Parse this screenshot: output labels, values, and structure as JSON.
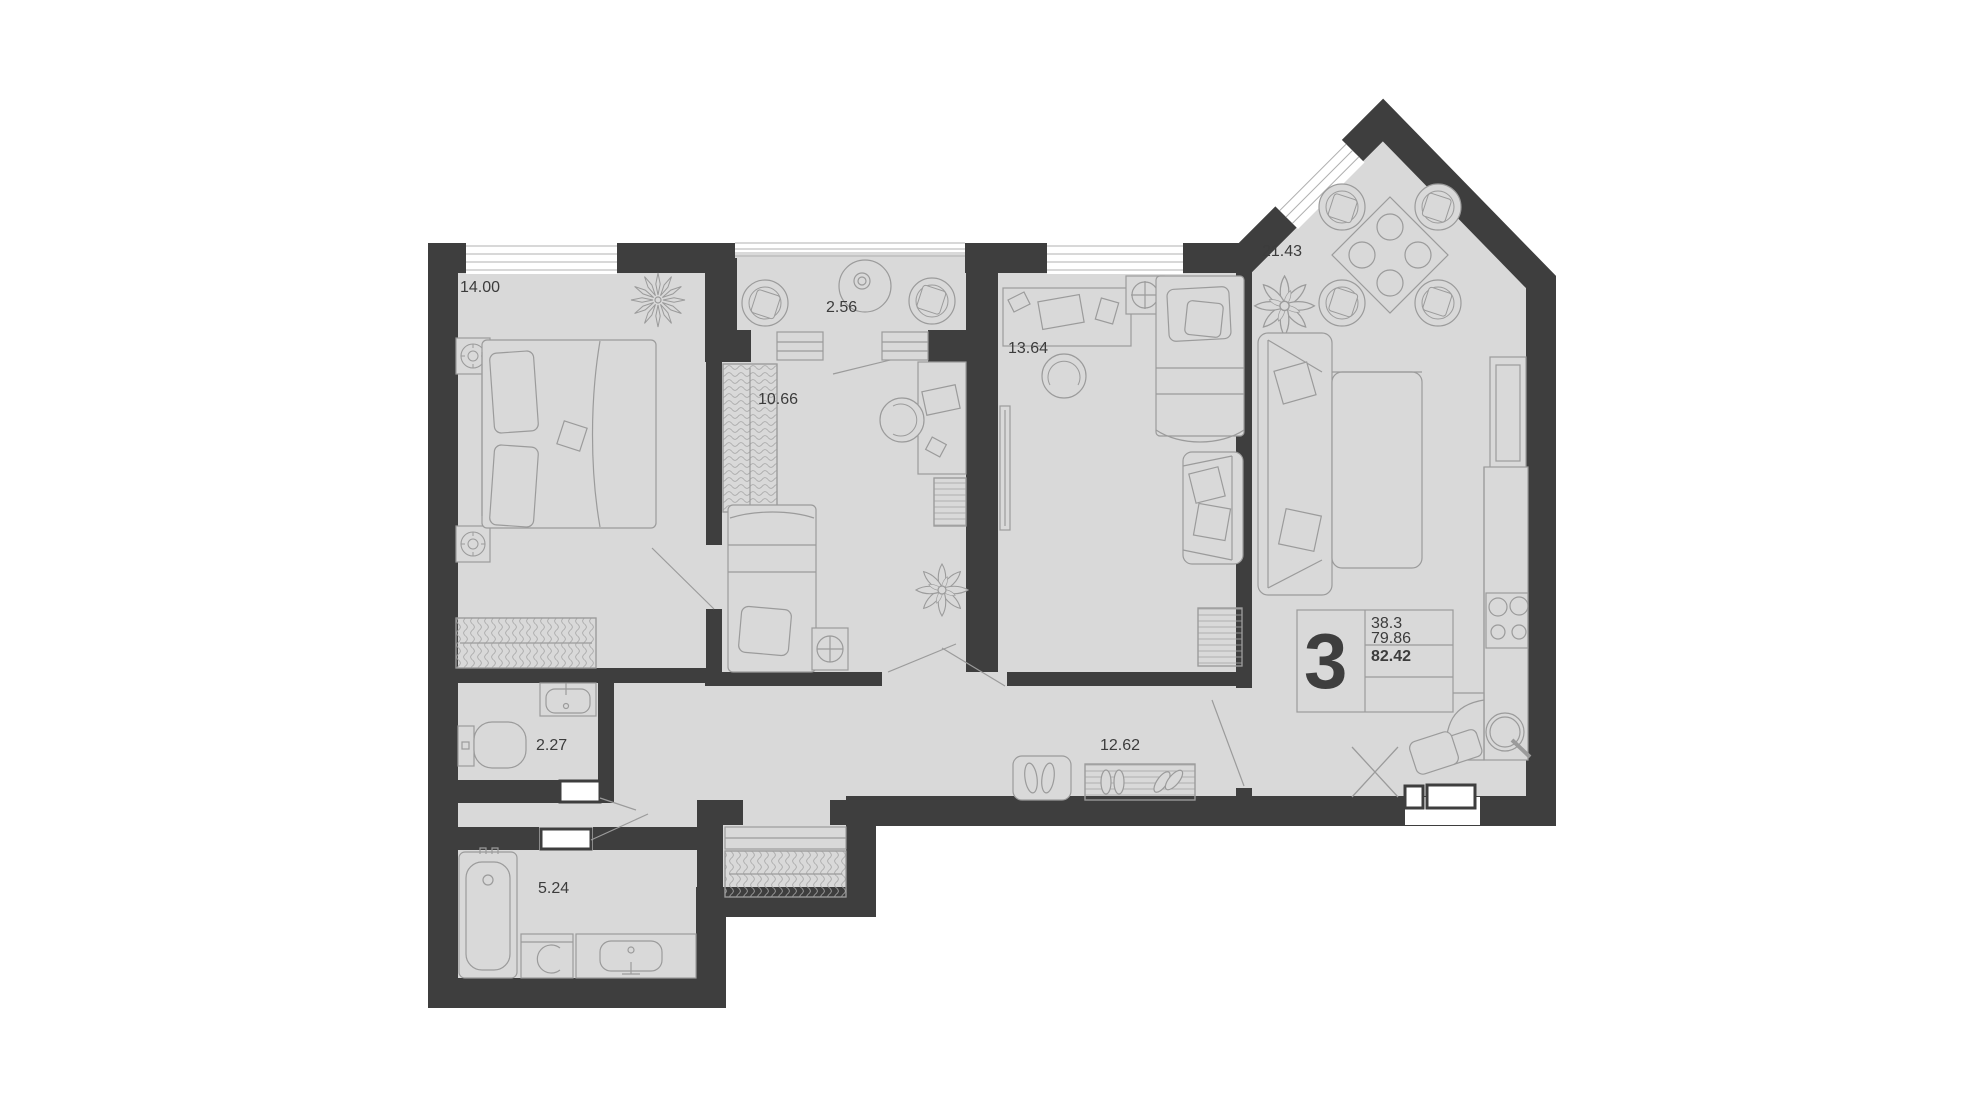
{
  "plan": {
    "legend": {
      "rooms_count": "3",
      "living_area": "38.3",
      "apartment_area": "79.86",
      "total_area": "82.42"
    },
    "rooms": [
      {
        "name": "bedroom",
        "area": "14.00"
      },
      {
        "name": "balcony",
        "area": "2.56"
      },
      {
        "name": "bedroom-2",
        "area": "10.66"
      },
      {
        "name": "bedroom-3",
        "area": "13.64"
      },
      {
        "name": "kitchen-living-room",
        "area": "21.43"
      },
      {
        "name": "wc",
        "area": "2.27"
      },
      {
        "name": "hallway",
        "area": "12.62"
      },
      {
        "name": "bathroom",
        "area": "5.24"
      }
    ],
    "colors": {
      "wall": "#3e3e3e",
      "floor": "#d9d9d9",
      "furniture_outline": "#9b9b9b",
      "background": "#ffffff",
      "text": "#3c3c3c"
    }
  }
}
